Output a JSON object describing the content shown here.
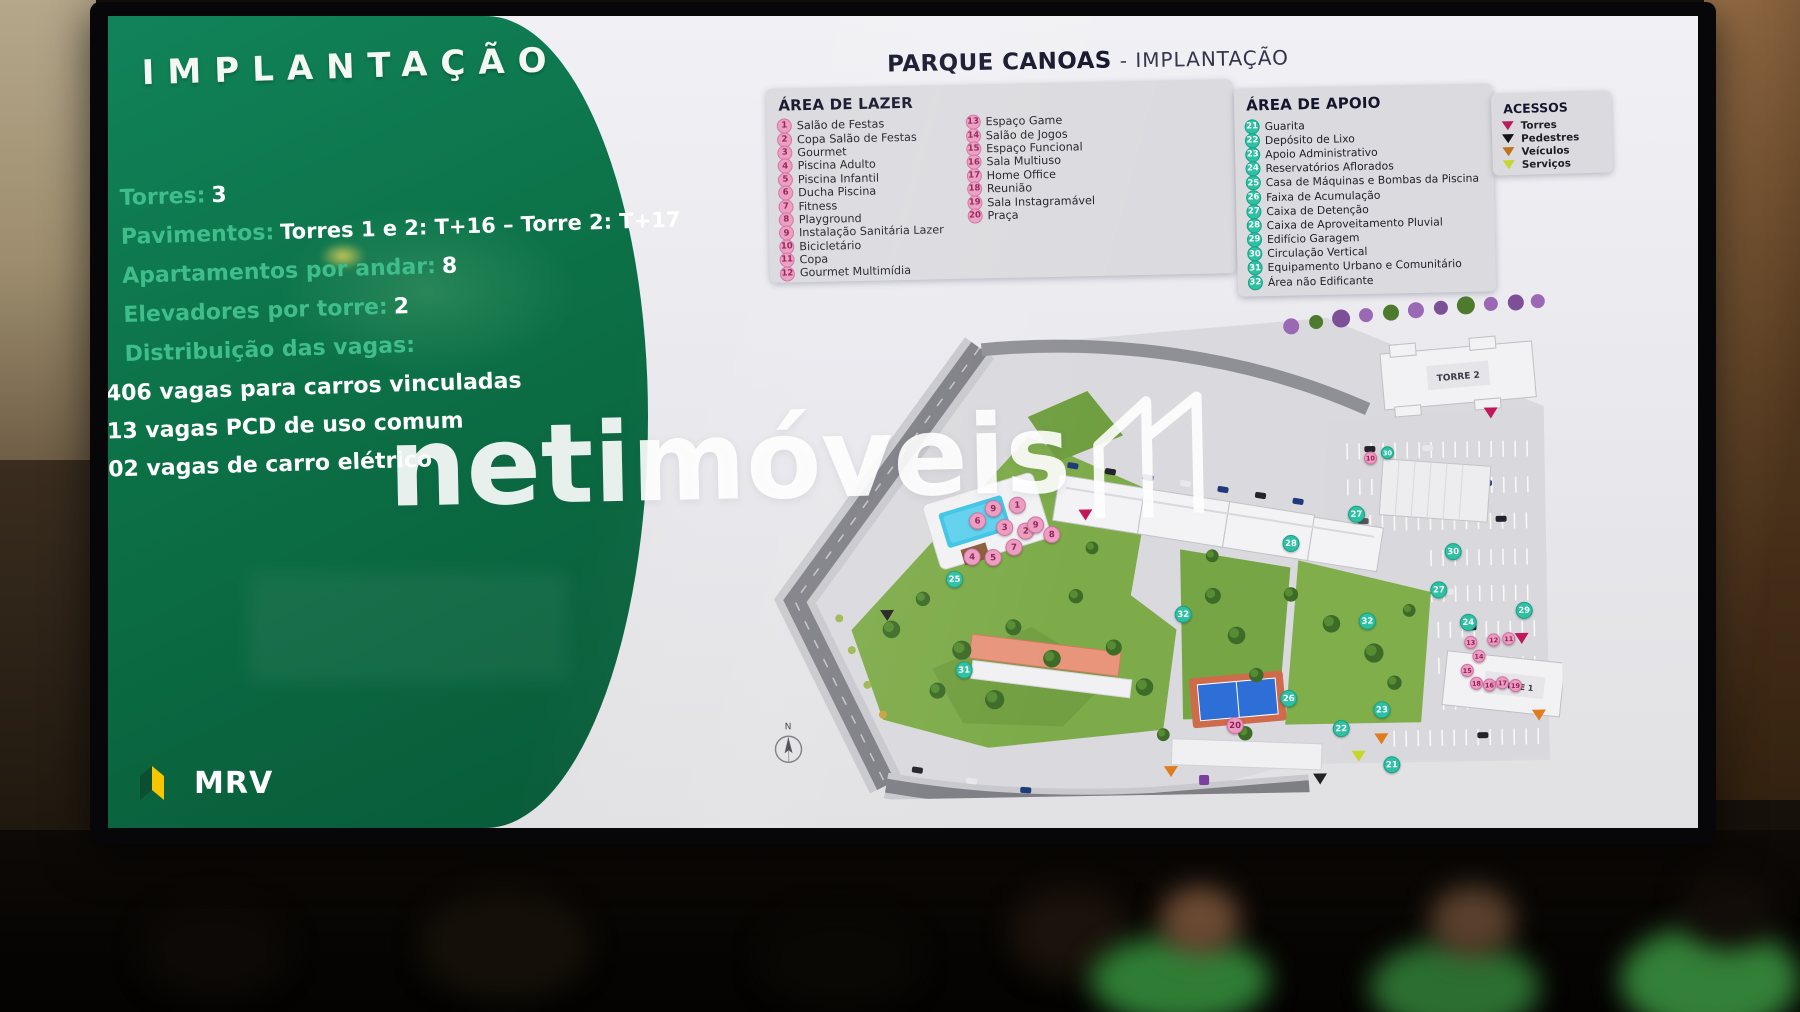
{
  "watermark": {
    "text": "netimóveis"
  },
  "slide": {
    "left_panel": {
      "title": "IMPLANTAÇÃO",
      "stats": [
        {
          "label": "Torres:",
          "value": "3"
        },
        {
          "label": "Pavimentos:",
          "value": "Torres 1 e 2: T+16 – Torre 2: T+17"
        },
        {
          "label": "Apartamentos por andar:",
          "value": "8"
        },
        {
          "label": "Elevadores por torre:",
          "value": "2"
        },
        {
          "label": "Distribuição das vagas:",
          "value": ""
        }
      ],
      "vagas": [
        "406 vagas  para carros vinculadas",
        "13 vagas PCD de uso comum",
        "02 vagas de carro elétrico"
      ],
      "logo_text": "MRV"
    },
    "header": {
      "project": "PARQUE CANOAS",
      "suffix": "- IMPLANTAÇÃO"
    },
    "legends": {
      "lazer": {
        "title": "ÁREA DE LAZER",
        "col1": [
          {
            "n": "1",
            "label": "Salão de Festas"
          },
          {
            "n": "2",
            "label": "Copa Salão de Festas"
          },
          {
            "n": "3",
            "label": "Gourmet"
          },
          {
            "n": "4",
            "label": "Piscina Adulto"
          },
          {
            "n": "5",
            "label": "Piscina Infantil"
          },
          {
            "n": "6",
            "label": "Ducha Piscina"
          },
          {
            "n": "7",
            "label": "Fitness"
          },
          {
            "n": "8",
            "label": "Playground"
          },
          {
            "n": "9",
            "label": "Instalação Sanitária Lazer"
          },
          {
            "n": "10",
            "label": "Bicicletário"
          },
          {
            "n": "11",
            "label": "Copa"
          },
          {
            "n": "12",
            "label": "Gourmet Multimídia"
          }
        ],
        "col2": [
          {
            "n": "13",
            "label": "Espaço Game"
          },
          {
            "n": "14",
            "label": "Salão de Jogos"
          },
          {
            "n": "15",
            "label": "Espaço Funcional"
          },
          {
            "n": "16",
            "label": "Sala Multiuso"
          },
          {
            "n": "17",
            "label": "Home Office"
          },
          {
            "n": "18",
            "label": "Reunião"
          },
          {
            "n": "19",
            "label": "Sala Instagramável"
          },
          {
            "n": "20",
            "label": "Praça"
          }
        ]
      },
      "apoio": {
        "title": "ÁREA DE APOIO",
        "items": [
          {
            "n": "21",
            "label": "Guarita"
          },
          {
            "n": "22",
            "label": "Depósito de Lixo"
          },
          {
            "n": "23",
            "label": "Apoio Administrativo"
          },
          {
            "n": "24",
            "label": "Reservatórios Aflorados"
          },
          {
            "n": "25",
            "label": "Casa de Máquinas e Bombas da Piscina"
          },
          {
            "n": "26",
            "label": "Faixa de Acumulação"
          },
          {
            "n": "27",
            "label": "Caixa de Detenção"
          },
          {
            "n": "28",
            "label": "Caixa de Aproveitamento Pluvial"
          },
          {
            "n": "29",
            "label": "Edifício Garagem"
          },
          {
            "n": "30",
            "label": "Circulação Vertical"
          },
          {
            "n": "31",
            "label": "Equipamento Urbano e Comunitário"
          },
          {
            "n": "32",
            "label": "Área não Edificante"
          }
        ]
      },
      "acessos": {
        "title": "ACESSOS",
        "items": [
          {
            "label": "Torres",
            "color": "#b81e5b"
          },
          {
            "label": "Pedestres",
            "color": "#141414"
          },
          {
            "label": "Veículos",
            "color": "#c0731d"
          },
          {
            "label": "Serviços",
            "color": "#c9d630"
          }
        ]
      }
    },
    "map": {
      "torre1_label": "TORRE 1",
      "torre2_label": "TORRE 2",
      "compass": "N",
      "markers": [
        {
          "t": "pink",
          "n": "9",
          "x": 264,
          "y": 211
        },
        {
          "t": "pink",
          "n": "1",
          "x": 288,
          "y": 208
        },
        {
          "t": "pink",
          "n": "3",
          "x": 275,
          "y": 230
        },
        {
          "t": "pink",
          "n": "2",
          "x": 296,
          "y": 234
        },
        {
          "t": "pink",
          "n": "9",
          "x": 306,
          "y": 228
        },
        {
          "t": "pink",
          "n": "7",
          "x": 284,
          "y": 250
        },
        {
          "t": "pink",
          "n": "6",
          "x": 248,
          "y": 223
        },
        {
          "t": "pink",
          "n": "4",
          "x": 242,
          "y": 259
        },
        {
          "t": "pink",
          "n": "5",
          "x": 263,
          "y": 260
        },
        {
          "t": "pink",
          "n": "8",
          "x": 322,
          "y": 238
        },
        {
          "t": "pink",
          "n": "10",
          "x": 642,
          "y": 167,
          "s": 1
        },
        {
          "t": "pink",
          "n": "20",
          "x": 502,
          "y": 432
        },
        {
          "t": "pink",
          "n": "13",
          "x": 739,
          "y": 353,
          "s": 1
        },
        {
          "t": "pink",
          "n": "12",
          "x": 762,
          "y": 351,
          "s": 1
        },
        {
          "t": "pink",
          "n": "11",
          "x": 777,
          "y": 350,
          "s": 1
        },
        {
          "t": "pink",
          "n": "14",
          "x": 747,
          "y": 367,
          "s": 1
        },
        {
          "t": "pink",
          "n": "15",
          "x": 735,
          "y": 381,
          "s": 1
        },
        {
          "t": "pink",
          "n": "16",
          "x": 757,
          "y": 396,
          "s": 1
        },
        {
          "t": "pink",
          "n": "17",
          "x": 770,
          "y": 394,
          "s": 1
        },
        {
          "t": "pink",
          "n": "18",
          "x": 744,
          "y": 394,
          "s": 1
        },
        {
          "t": "pink",
          "n": "19",
          "x": 783,
          "y": 397,
          "s": 1
        },
        {
          "t": "teal",
          "n": "21",
          "x": 658,
          "y": 474
        },
        {
          "t": "teal",
          "n": "22",
          "x": 608,
          "y": 437
        },
        {
          "t": "teal",
          "n": "23",
          "x": 649,
          "y": 419
        },
        {
          "t": "teal",
          "n": "24",
          "x": 737,
          "y": 333
        },
        {
          "t": "teal",
          "n": "25",
          "x": 224,
          "y": 281
        },
        {
          "t": "teal",
          "n": "26",
          "x": 556,
          "y": 406
        },
        {
          "t": "teal",
          "n": "27",
          "x": 627,
          "y": 223
        },
        {
          "t": "teal",
          "n": "27",
          "x": 708,
          "y": 300
        },
        {
          "t": "teal",
          "n": "28",
          "x": 561,
          "y": 251
        },
        {
          "t": "teal",
          "n": "29",
          "x": 793,
          "y": 322
        },
        {
          "t": "teal",
          "n": "30",
          "x": 723,
          "y": 262
        },
        {
          "t": "teal",
          "n": "30",
          "x": 659,
          "y": 162,
          "s": 1
        },
        {
          "t": "teal",
          "n": "31",
          "x": 232,
          "y": 372
        },
        {
          "t": "teal",
          "n": "32",
          "x": 452,
          "y": 320
        },
        {
          "t": "teal",
          "n": "32",
          "x": 636,
          "y": 330
        }
      ],
      "arrows": [
        {
          "shape": "triangle",
          "color": "#c2185b",
          "x": 763,
          "y": 124
        },
        {
          "shape": "triangle",
          "color": "#c2185b",
          "x": 790,
          "y": 350
        },
        {
          "shape": "triangle",
          "color": "#c2185b",
          "x": 356,
          "y": 219
        },
        {
          "shape": "triangle",
          "color": "#e07b1f",
          "x": 437,
          "y": 477
        },
        {
          "shape": "triangle",
          "color": "#e07b1f",
          "x": 648,
          "y": 448
        },
        {
          "shape": "triangle",
          "color": "#e07b1f",
          "x": 806,
          "y": 427
        },
        {
          "shape": "triangle",
          "color": "#222222",
          "x": 156,
          "y": 316
        },
        {
          "shape": "triangle",
          "color": "#222222",
          "x": 586,
          "y": 487
        },
        {
          "shape": "triangle",
          "color": "#c6d62a",
          "x": 625,
          "y": 465
        },
        {
          "shape": "square",
          "color": "#7b3fa0",
          "x": 470,
          "y": 486
        }
      ]
    }
  }
}
